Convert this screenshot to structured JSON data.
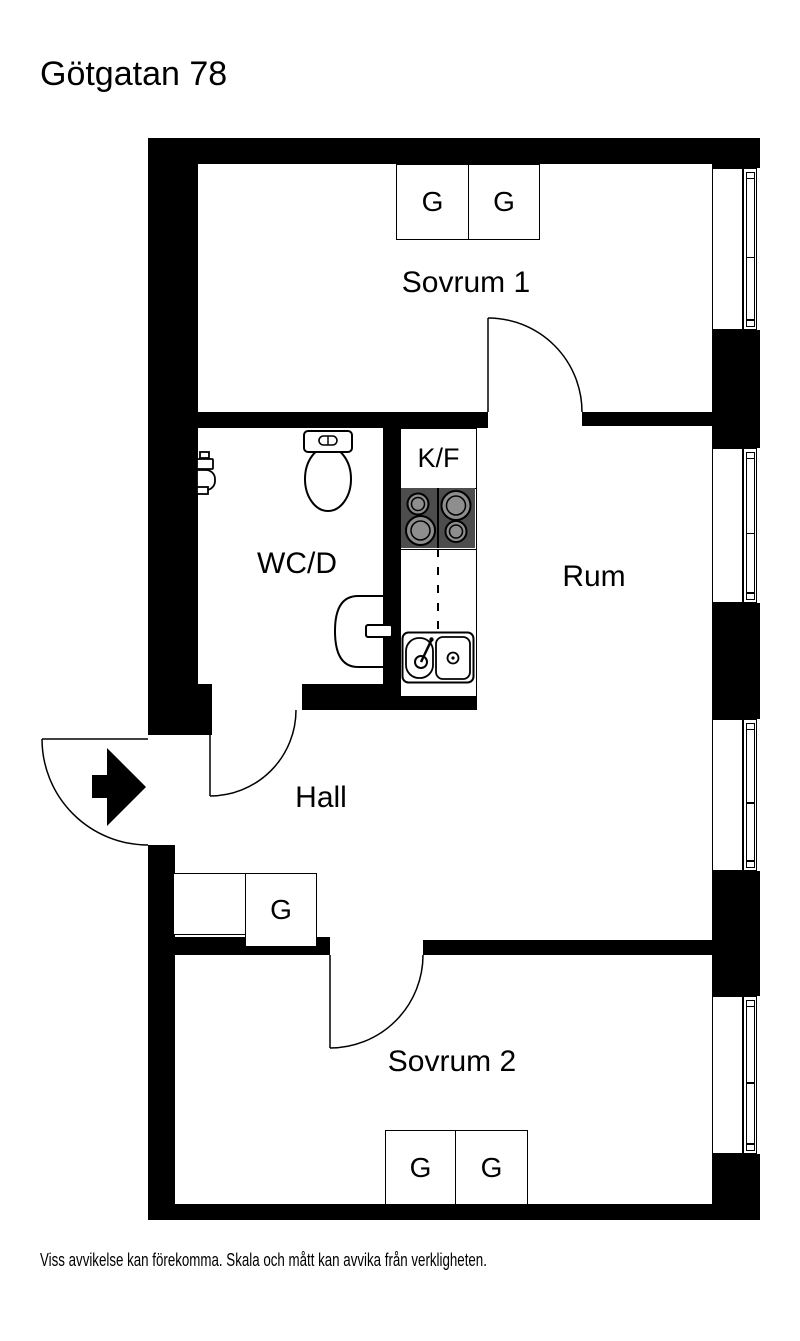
{
  "title": "Götgatan 78",
  "disclaimer": "Viss avvikelse kan förekomma. Skala och mått kan avvika från verkligheten.",
  "rooms": {
    "sovrum1": {
      "label": "Sovrum 1"
    },
    "wcd": {
      "label": "WC/D"
    },
    "kitchen": {
      "label": "K/F"
    },
    "rum": {
      "label": "Rum"
    },
    "hall": {
      "label": "Hall"
    },
    "sovrum2": {
      "label": "Sovrum 2"
    }
  },
  "wardrobes": {
    "sovrum1": [
      "G",
      "G"
    ],
    "hall": "G",
    "sovrum2": [
      "G",
      "G"
    ]
  },
  "fixtures": {
    "entrance": "entrance-arrow-icon",
    "toilet": "toilet-icon",
    "basin": "wash-basin-icon",
    "laundry_tap": "laundry-tap-icon",
    "stove": "stove-icon",
    "sink": "kitchen-sink-icon",
    "window": "window-icon",
    "door": "door-swing-icon"
  },
  "colors": {
    "wall": "#000000",
    "stove_body": "#4d4d4d",
    "burner": "#8e8e8e",
    "background": "#ffffff"
  }
}
